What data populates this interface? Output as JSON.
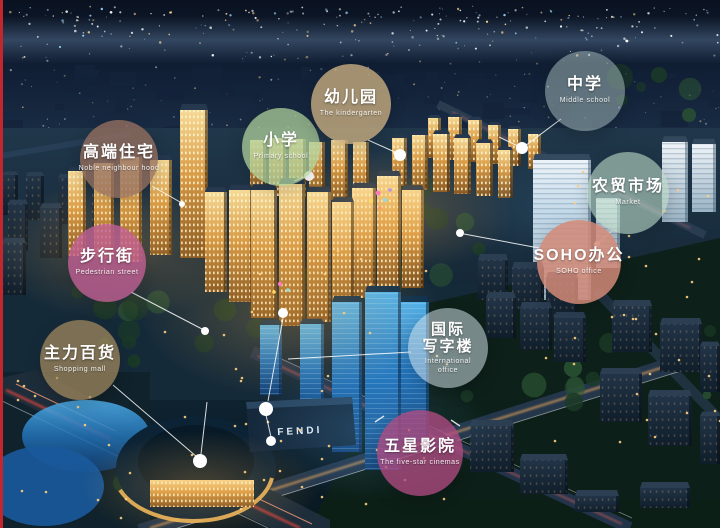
{
  "page": {
    "background": "#0a1420",
    "frame_color": "#c1272d"
  },
  "mall_sign": {
    "text": "FENDI"
  },
  "labels": [
    {
      "id": "premium-residential",
      "zh": "高端住宅",
      "en": "Noble neighbour hood",
      "color": "#96705f",
      "opacity": 0.78,
      "x": 119,
      "y": 159,
      "d": 78
    },
    {
      "id": "primary-school",
      "zh": "小学",
      "en": "Primary school",
      "color": "#aecf9a",
      "opacity": 0.75,
      "x": 281,
      "y": 147,
      "d": 78
    },
    {
      "id": "kindergarten",
      "zh": "幼儿园",
      "en": "The kindergarten",
      "color": "#c7ad7f",
      "opacity": 0.8,
      "x": 351,
      "y": 104,
      "d": 80
    },
    {
      "id": "middle-school",
      "zh": "中学",
      "en": "Middle school",
      "color": "#9fb4b4",
      "opacity": 0.55,
      "x": 585,
      "y": 91,
      "d": 80
    },
    {
      "id": "farmers-market",
      "zh": "农贸市场",
      "en": "Market",
      "color": "#b9d6c3",
      "opacity": 0.62,
      "x": 628,
      "y": 193,
      "d": 82
    },
    {
      "id": "soho-office",
      "zh": "SOHO办公",
      "en": "SOHO office",
      "color": "#d28a77",
      "opacity": 0.85,
      "x": 579,
      "y": 262,
      "d": 84
    },
    {
      "id": "pedestrian-street",
      "zh": "步行街",
      "en": "Pedestrian street",
      "color": "#c05f93",
      "opacity": 0.8,
      "x": 107,
      "y": 263,
      "d": 78
    },
    {
      "id": "anchor-department-store",
      "zh": "主力百货",
      "en": "Shopping mall",
      "color": "#a58a5e",
      "opacity": 0.72,
      "x": 80,
      "y": 360,
      "d": 80
    },
    {
      "id": "international-office",
      "zh": "国际",
      "zh2": "写字楼",
      "en": "International",
      "en2": "office",
      "color": "#cfdfe6",
      "opacity": 0.55,
      "x": 448,
      "y": 348,
      "d": 80
    },
    {
      "id": "five-star-cinema",
      "zh": "五星影院",
      "en": "The five-star cinemas",
      "color": "#b04a80",
      "opacity": 0.78,
      "x": 420,
      "y": 453,
      "d": 86
    }
  ]
}
